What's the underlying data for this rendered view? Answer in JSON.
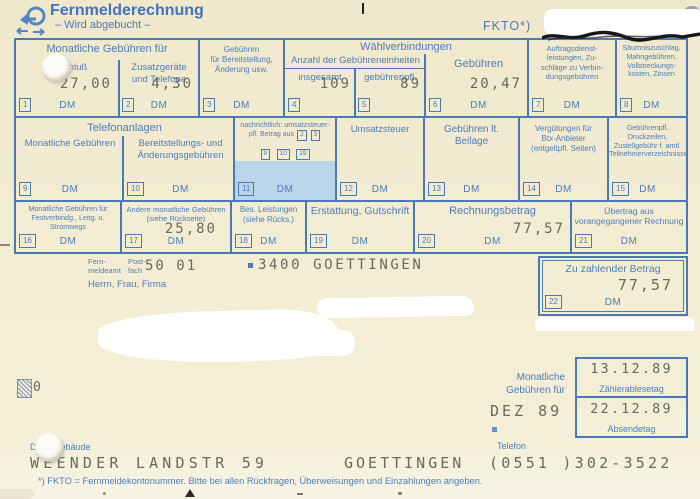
{
  "header": {
    "title": "Fernmelderechnung",
    "subtitle": "– Wird abgebucht –",
    "fkto": "FKTO*)",
    "logo": "posthorn-icon"
  },
  "table": {
    "groups": {
      "monthly": "Monatliche Gebühren für",
      "dial": "Wählverbindungen",
      "units": "Anzahl der Gebühreneinheiten",
      "phone": "Telefonanlagen"
    },
    "cells": [
      {
        "num": "1",
        "label": "Anschluß",
        "value": "27,00",
        "unit": "DM"
      },
      {
        "num": "2",
        "label": "Zusatzgeräte\nund Telefone",
        "value": "4,30",
        "unit": "DM"
      },
      {
        "num": "3",
        "label": "Gebühren\nfür Bereitstellung,\nÄnderung usw.",
        "value": "",
        "unit": "DM"
      },
      {
        "num": "4",
        "label": "insgesamt",
        "value": "109",
        "unit": ""
      },
      {
        "num": "5",
        "label": "gebührenpfl.",
        "value": "89",
        "unit": ""
      },
      {
        "num": "6",
        "label": "Gebühren",
        "value": "20,47",
        "unit": "DM"
      },
      {
        "num": "7",
        "label": "Auftragsdienst-\nleistungen, Zu-\nschläge zu Verbin-\ndungsgebühren",
        "value": "",
        "unit": "DM"
      },
      {
        "num": "8",
        "label": "Säumniszuschlag,\nMahngebühren,\nVollstreckungs-\nkosten, Zinsen",
        "value": "",
        "unit": "DM"
      },
      {
        "num": "9",
        "label": "Monatliche Gebühren",
        "value": "",
        "unit": "DM"
      },
      {
        "num": "10",
        "label": "Bereitstellungs- und\nÄnderungsgebühren",
        "value": "",
        "unit": "DM"
      },
      {
        "num": "11",
        "label_line1": "nachrichtlich: umsatzsteuer-",
        "label_line2": "pfl. Betrag aus",
        "refs": [
          "2",
          "3",
          "9",
          "10",
          "19"
        ],
        "value": "",
        "unit": "DM"
      },
      {
        "num": "12",
        "label": "Umsatzsteuer",
        "value": "",
        "unit": "DM"
      },
      {
        "num": "13",
        "label": "Gebühren lt.\nBeilage",
        "value": "",
        "unit": "DM"
      },
      {
        "num": "14",
        "label": "Vergütungen für\nBtx-Anbieter\n(entgeltpfl. Seiten)",
        "value": "",
        "unit": "DM"
      },
      {
        "num": "15",
        "label": "Gebührenpfl. Druckzeilen,\nZustellgebühr f. amtl.\nTeilnehmerverzeichnisse",
        "value": "",
        "unit": "DM"
      },
      {
        "num": "16",
        "label": "Monatliche Gebühren für\nFestverbindg., Leitg. u. Stromwegs",
        "value": "",
        "unit": "DM"
      },
      {
        "num": "17",
        "label": "Andere monatliche Gebühren\n(siehe Rückseite)",
        "value": "25,80",
        "unit": "DM"
      },
      {
        "num": "18",
        "label": "Bes. Leistungen\n(siehe Rücks.)",
        "value": "",
        "unit": "DM"
      },
      {
        "num": "19",
        "label": "Erstattung, Gutschrift",
        "value": "",
        "unit": "DM"
      },
      {
        "num": "20",
        "label": "Rechnungsbetrag",
        "value": "77,57",
        "unit": "DM"
      },
      {
        "num": "21",
        "label": "Übertrag aus\nvorangegangener Rechnung",
        "value": "",
        "unit": "DM"
      }
    ]
  },
  "address": {
    "office_label": "Fern-\nmeldeamt",
    "pobox_label": "Post-\nfach",
    "pobox_value": "50 01",
    "city_line": "3400 GOETTINGEN",
    "salutation": "Herrn, Frau, Firma"
  },
  "pay_box": {
    "label": "Zu zahlender Betrag",
    "value": "77,57",
    "num": "22",
    "unit": "DM"
  },
  "period": {
    "label": "Monatliche\nGebühren für",
    "value": "DEZ 89"
  },
  "dates": [
    {
      "value": "13.12.89",
      "label": "Zählerablesetag"
    },
    {
      "value": "22.12.89",
      "label": "Absendetag"
    }
  ],
  "bottom": {
    "building_label": "Dienstgebäude",
    "street": "WEENDER LANDSTR 59",
    "city": "GOETTINGEN",
    "phone_label": "Telefon",
    "phone": "(0551 )302-3522",
    "stray_digit": "0"
  },
  "footnote": "*) FKTO = Fernmeldekontonummer. Bitte bei allen Rückfragen, Überweisungen und Einzahlungen angeben."
}
